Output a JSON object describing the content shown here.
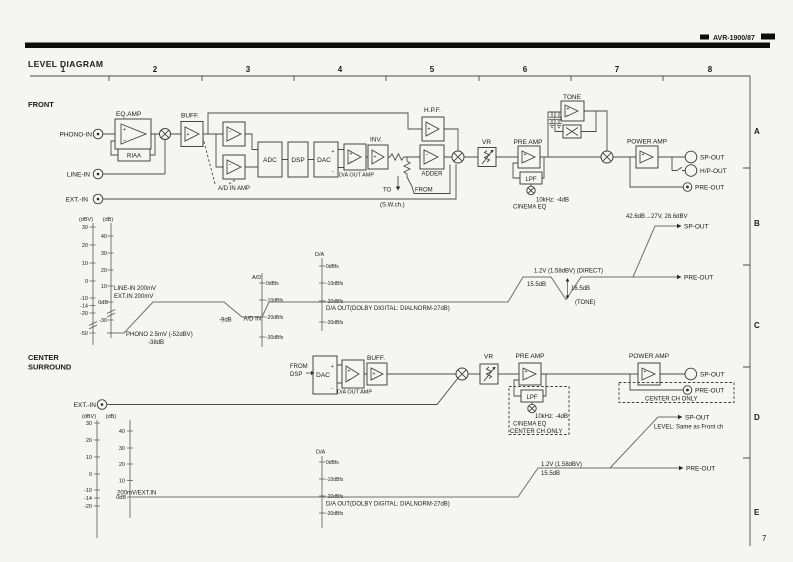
{
  "page": {
    "model_label": "AVR-1900/87",
    "title": "LEVEL DIAGRAM",
    "page_number": "7"
  },
  "grid": {
    "columns": [
      "1",
      "2",
      "3",
      "4",
      "5",
      "6",
      "7",
      "8"
    ],
    "rows": [
      "A",
      "B",
      "C",
      "D",
      "E"
    ]
  },
  "sym": {
    "plus": "+",
    "minus": "−"
  },
  "front": {
    "section": "FRONT",
    "phono_in": "PHONO-IN",
    "line_in": "LINE-IN",
    "ext_in": "EXT.-IN",
    "eq_amp": "EQ.AMP",
    "riaa": "RIAA",
    "buff": "BUFF.",
    "ad_in_amp": "A/D IN AMP",
    "adc": "ADC",
    "dsp": "DSP",
    "dac": "DAC",
    "da_out_amp": "D/A OUT AMP",
    "inv": "INV.",
    "adder": "ADDER",
    "hpf": "H.P.F.",
    "sw_to": "TO",
    "sw_from": "FROM",
    "sw_ch": "(S.W.ch.)",
    "vr": "VR",
    "pre_amp": "PRE AMP",
    "lpf": "LPF",
    "cinema_eq_freq": "10kHz: -4dB",
    "cinema_eq": "CINEMA EQ",
    "tone": "TONE",
    "power_amp": "POWER AMP",
    "sp_out": "SP-OUT",
    "hp_out": "H/P-OUT",
    "pre_out": "PRE-OUT"
  },
  "front_chart": {
    "dbv_caption": "(dBV)",
    "dbv_ticks": [
      "30",
      "20",
      "10",
      "0",
      "-10",
      "-14",
      "-20",
      "-50"
    ],
    "db_caption": "(dB)",
    "db_ticks": [
      "40",
      "30",
      "20",
      "10",
      "0dB",
      "-30"
    ],
    "ad_caption": "A/D",
    "ad_ticks": [
      "0dBfs",
      "-10dBfs",
      "-20dBfs",
      "-30dBfs"
    ],
    "da_caption": "D/A",
    "da_ticks": [
      "0dBfs",
      "-10dBfs",
      "-20dBfs",
      "-30dBfs"
    ],
    "line_in_level": "LINE-IN 200mV",
    "ext_in_level": "EXT.IN 200mV",
    "phono_level": "PHONO 2.5mV (-52dBV)",
    "phono_gain": "-38dB",
    "ad_drop": "-9dB",
    "ad_in_label": "A/D IN",
    "da_out_label": "D/A OUT(DOLBY DIGITAL: DIALNORM-27dB)",
    "direct_level": "1.2V (1.58dBV) (DIRECT)",
    "pre_gain": "15.5dB",
    "tone_dip": "16.5dB",
    "tone_label": "(TONE)",
    "sp_gain": "42.6dB→27V, 28.6dBV",
    "sp_out": "SP-OUT",
    "pre_out": "PRE-OUT"
  },
  "center": {
    "section_line1": "CENTER",
    "section_line2": "SURROUND",
    "from_line1": "FROM",
    "from_line2": "DSP",
    "ext_in": "EXT.-IN",
    "dac": "DAC",
    "da_out_amp": "D/A OUT AMP",
    "buff": "BUFF.",
    "vr": "VR",
    "pre_amp": "PRE AMP",
    "lpf": "LPF",
    "cinema_eq_freq": "10kHz: -4dB",
    "cinema_eq": "CINEMA EQ",
    "cinema_eq_only": "CENTER CH ONLY",
    "power_amp": "POWER AMP",
    "sp_out": "SP-OUT",
    "pre_out": "PRE-OUT",
    "pre_out_only": "CENTER CH ONLY"
  },
  "center_chart": {
    "dbv_caption": "(dBV)",
    "dbv_ticks": [
      "30",
      "20",
      "10",
      "0",
      "-10",
      "-14",
      "-20"
    ],
    "db_caption": "(dB)",
    "db_ticks": [
      "40",
      "30",
      "20",
      "10",
      "0dB"
    ],
    "da_caption": "D/A",
    "da_ticks": [
      "0dBfs",
      "-10dBfs",
      "-20dBfs",
      "-30dBfs"
    ],
    "input_level": "200mV/EXT.IN",
    "da_out_label": "D/A OUT(DOLBY DIGITAL: DIALNORM-27dB)",
    "pre_level": "1.2V (1.58dBV)",
    "pre_gain": "15.5dB",
    "sp_out": "SP-OUT",
    "sp_note": "LEVEL:  Same as Front ch",
    "pre_out": "PRE-OUT"
  }
}
